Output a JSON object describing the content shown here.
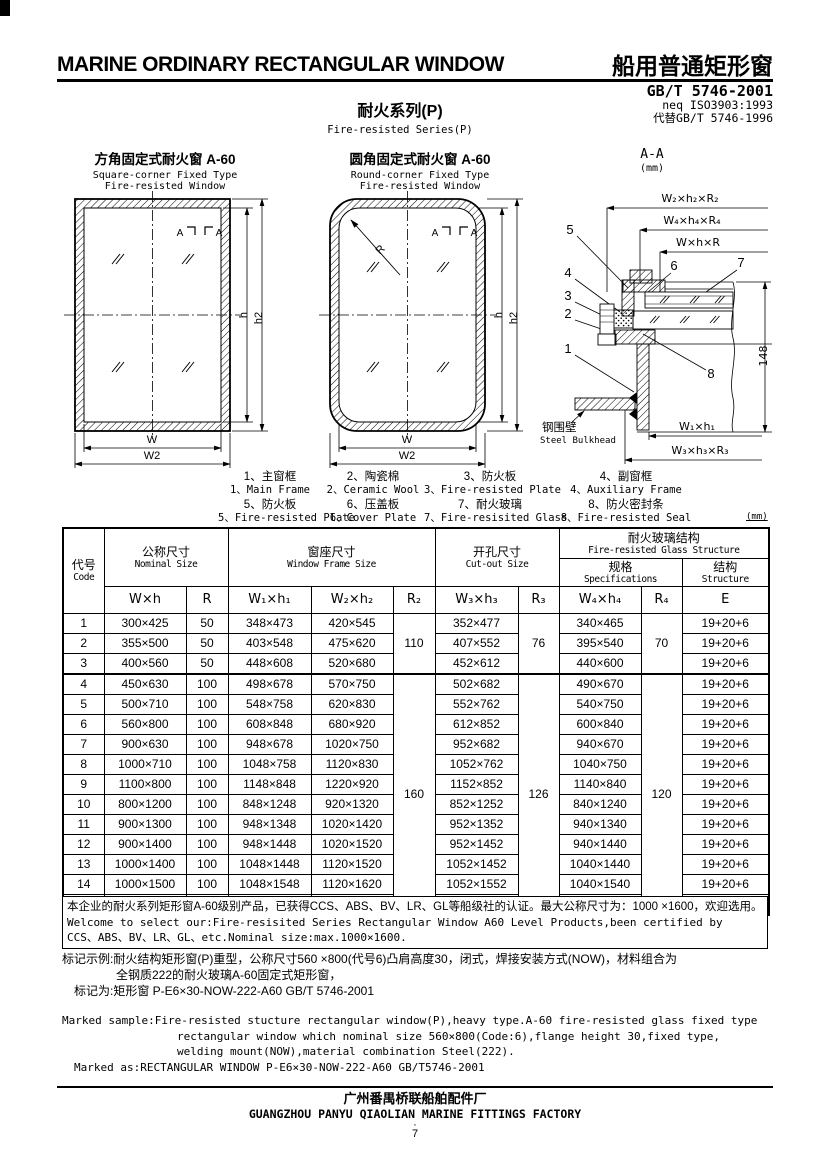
{
  "header": {
    "title_en": "MARINE ORDINARY RECTANGULAR WINDOW",
    "title_zh": "船用普通矩形窗",
    "standard": "GB/T 5746-2001",
    "standard_neq": "neq ISO3903:1993",
    "standard_replace": "代替GB/T 5746-1996",
    "series_zh": "耐火系列(P)",
    "series_en": "Fire-resisted Series(P)"
  },
  "diagrams": {
    "square": {
      "title_zh": "方角固定式耐火窗  A-60",
      "title_en1": "Square-corner Fixed Type",
      "title_en2": "Fire-resisted Window",
      "mark_a": "A",
      "dim_w": "W",
      "dim_w2": "W2",
      "dim_h": "h",
      "dim_h2": "h2"
    },
    "round": {
      "title_zh": "圆角固定式耐火窗  A-60",
      "title_en1": "Round-corner Fixed Type",
      "title_en2": "Fire-resisted Window",
      "mark_a": "A",
      "radius_label": "R",
      "dim_w": "W",
      "dim_w2": "W2",
      "dim_h": "h",
      "dim_h2": "h2"
    },
    "section": {
      "title": "A-A",
      "unit": "(mm)",
      "dims_top": [
        "W₂×h₂×R₂",
        "W₄×h₄×R₄",
        "W×h×R"
      ],
      "dim_height": "148",
      "dims_bottom": [
        "W₁×h₁",
        "W₃×h₃×R₃"
      ],
      "callouts": [
        "1",
        "2",
        "3",
        "4",
        "5",
        "6",
        "7",
        "8"
      ],
      "bulkhead_zh": "钢围壁",
      "bulkhead_en": "Steel Bulkhead"
    }
  },
  "legend": {
    "unit_note": "(mm)",
    "items": [
      {
        "zh": "1、主窗框",
        "en": "1、Main Frame"
      },
      {
        "zh": "2、陶瓷棉",
        "en": "2、Ceramic Wool"
      },
      {
        "zh": "3、防火板",
        "en": "3、Fire-resisted Plate"
      },
      {
        "zh": "4、副窗框",
        "en": "4、Auxiliary Frame"
      },
      {
        "zh": "5、防火板",
        "en": "5、Fire-resisted Plate"
      },
      {
        "zh": "6、压盖板",
        "en": "6、Cover Plate"
      },
      {
        "zh": "7、耐火玻璃",
        "en": "7、Fire-resisited Glass"
      },
      {
        "zh": "8、防火密封条",
        "en": "8、Fire-resisted Seal"
      }
    ]
  },
  "table": {
    "header": {
      "code_zh": "代号",
      "code_en": "Code",
      "nominal_zh": "公称尺寸",
      "nominal_en": "Nominal Size",
      "frame_zh": "窗座尺寸",
      "frame_en": "Window Frame Size",
      "cutout_zh": "开孔尺寸",
      "cutout_en": "Cut-out Size",
      "glass_zh": "耐火玻璃结构",
      "glass_en": "Fire-resisted Glass Structure",
      "spec_zh": "规格",
      "spec_en": "Specifications",
      "struct_zh": "结构",
      "struct_en": "Structure",
      "symbols": [
        "W×h",
        "R",
        "W₁×h₁",
        "W₂×h₂",
        "R₂",
        "W₃×h₃",
        "R₃",
        "W₄×h₄",
        "R₄",
        "E"
      ]
    },
    "merged": {
      "r2": [
        "110",
        "160"
      ],
      "r3": [
        "76",
        "126"
      ],
      "r4": [
        "70",
        "120"
      ]
    },
    "rows": [
      [
        "1",
        "300×425",
        "50",
        "348×473",
        "420×545",
        "352×477",
        "340×465",
        "19+20+6"
      ],
      [
        "2",
        "355×500",
        "50",
        "403×548",
        "475×620",
        "407×552",
        "395×540",
        "19+20+6"
      ],
      [
        "3",
        "400×560",
        "50",
        "448×608",
        "520×680",
        "452×612",
        "440×600",
        "19+20+6"
      ],
      [
        "4",
        "450×630",
        "100",
        "498×678",
        "570×750",
        "502×682",
        "490×670",
        "19+20+6"
      ],
      [
        "5",
        "500×710",
        "100",
        "548×758",
        "620×830",
        "552×762",
        "540×750",
        "19+20+6"
      ],
      [
        "6",
        "560×800",
        "100",
        "608×848",
        "680×920",
        "612×852",
        "600×840",
        "19+20+6"
      ],
      [
        "7",
        "900×630",
        "100",
        "948×678",
        "1020×750",
        "952×682",
        "940×670",
        "19+20+6"
      ],
      [
        "8",
        "1000×710",
        "100",
        "1048×758",
        "1120×830",
        "1052×762",
        "1040×750",
        "19+20+6"
      ],
      [
        "9",
        "1100×800",
        "100",
        "1148×848",
        "1220×920",
        "1152×852",
        "1140×840",
        "19+20+6"
      ],
      [
        "10",
        "800×1200",
        "100",
        "848×1248",
        "920×1320",
        "852×1252",
        "840×1240",
        "19+20+6"
      ],
      [
        "11",
        "900×1300",
        "100",
        "948×1348",
        "1020×1420",
        "952×1352",
        "940×1340",
        "19+20+6"
      ],
      [
        "12",
        "900×1400",
        "100",
        "948×1448",
        "1020×1520",
        "952×1452",
        "940×1440",
        "19+20+6"
      ],
      [
        "13",
        "1000×1400",
        "100",
        "1048×1448",
        "1120×1520",
        "1052×1452",
        "1040×1440",
        "19+20+6"
      ],
      [
        "14",
        "1000×1500",
        "100",
        "1048×1548",
        "1120×1620",
        "1052×1552",
        "1040×1540",
        "19+20+6"
      ],
      [
        "15",
        "1000×1600",
        "100",
        "1048×1648",
        "1120×1720",
        "1052×1652",
        "1040×1640",
        "19+20+6"
      ]
    ],
    "note": {
      "zh": "本企业的耐火系列矩形窗A-60级别产品，已获得CCS、ABS、BV、LR、GL等船级社的认证。最大公称尺寸为：1000 ×1600，欢迎选用。",
      "en1": "Welcome to select our:Fire-resisited Series Rectangular Window A60 Level Products,been certified by",
      "en2": "CCS、ABS、BV、LR、GL、etc.Nominal size:max.1000×1600."
    }
  },
  "marking": {
    "zh1": "标记示例:耐火结构矩形窗(P)重型，公称尺寸560 ×800(代号6)凸肩高度30，闭式，焊接安装方式(NOW)，材料组合为",
    "zh2": "全钢质222的耐火玻璃A-60固定式矩形窗，",
    "zh3": "标记为:矩形窗  P-E6×30-NOW-222-A60  GB/T 5746-2001",
    "en1": "Marked sample:Fire-resisted stucture rectangular window(P),heavy type.A-60 fire-resisted glass fixed type",
    "en2": "rectangular window which nominal size 560×800(Code:6),flange height 30,fixed type,",
    "en3": "welding mount(NOW),material combination Steel(222).",
    "en4": "Marked as:RECTANGULAR WINDOW  P-E6×30-NOW-222-A60  GB/T5746-2001"
  },
  "footer": {
    "factory_zh": "广州番禺桥联船舶配件厂",
    "factory_en": "GUANGZHOU PANYU QIAOLIAN MARINE FITTINGS FACTORY",
    "page_dot": "·",
    "page_num": "7"
  }
}
